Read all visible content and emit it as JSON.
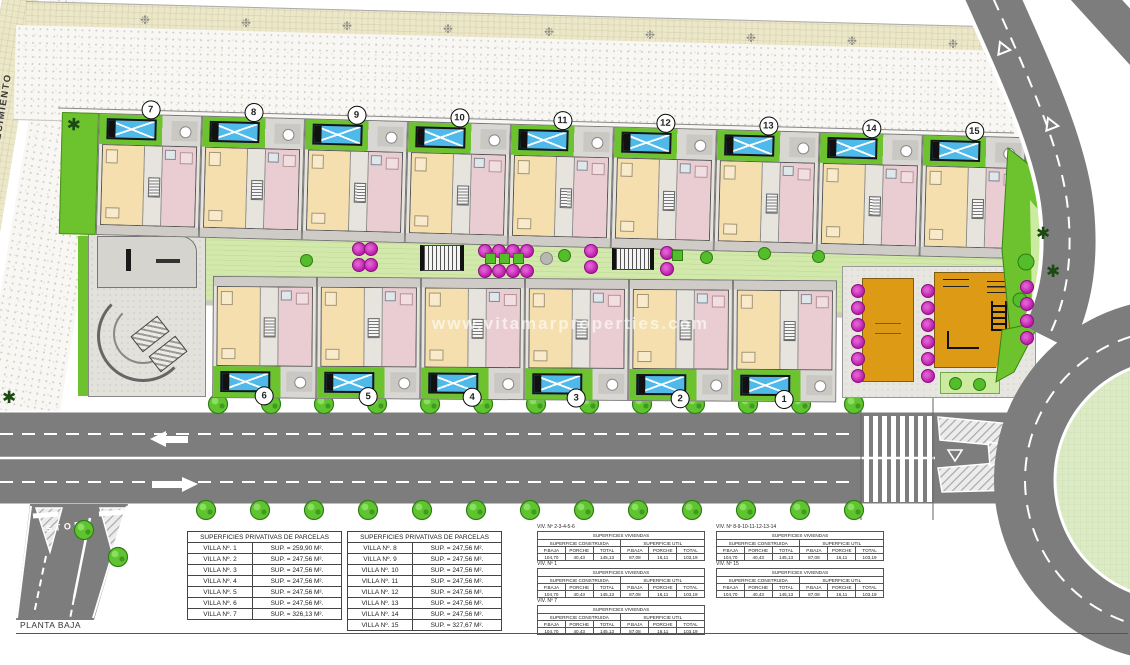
{
  "title": {
    "plan_label": "PLANTA BAJA"
  },
  "zones": {
    "protection_band": "BANDA DE PROTECCION TUBERIA ABASTECIMIENTO",
    "stop_marking": "STOP"
  },
  "watermark": "www.vitamarproperties.com",
  "icons": {
    "conifer_tree": "✱",
    "shrub": "❉"
  },
  "colors": {
    "road_gray": "#7d7d7d",
    "grass_green": "#6cc32e",
    "lawn_green": "#d2e9ab",
    "pool_blue": "#4fb9e9",
    "floor_beige": "#f5dfae",
    "floor_pink": "#eacdd2",
    "playground_orange": "#dd9b15",
    "tree_magenta": "#c52fb5",
    "band_cream": "#ece7c7",
    "roundabout_center": "#dcebc6"
  },
  "villas": {
    "top_numbers": [
      "7",
      "8",
      "9",
      "10",
      "11",
      "12",
      "13",
      "14",
      "15"
    ],
    "bottom_numbers": [
      "6",
      "5",
      "4",
      "3",
      "2",
      "1"
    ]
  },
  "tables": {
    "parcelas": [
      {
        "title": "SUPERFICIES PRIVATIVAS DE PARCELAS",
        "rows": [
          [
            "VILLA Nº. 1",
            "SUP. = 259,90 M²."
          ],
          [
            "VILLA Nº. 2",
            "SUP. = 247,56 M²."
          ],
          [
            "VILLA Nº. 3",
            "SUP. = 247,56 M²."
          ],
          [
            "VILLA Nº. 4",
            "SUP. = 247,56 M²."
          ],
          [
            "VILLA Nº. 5",
            "SUP. = 247,56 M²."
          ],
          [
            "VILLA Nº. 6",
            "SUP. = 247,56 M²."
          ],
          [
            "VILLA Nº. 7",
            "SUP. = 326,13 M²."
          ]
        ]
      },
      {
        "title": "SUPERFICIES PRIVATIVAS DE PARCELAS",
        "rows": [
          [
            "VILLA Nº. 8",
            "SUP. = 247,56 M²."
          ],
          [
            "VILLA Nº. 9",
            "SUP. = 247,56 M²."
          ],
          [
            "VILLA Nº. 10",
            "SUP. = 247,56 M²."
          ],
          [
            "VILLA Nº. 11",
            "SUP. = 247,56 M²."
          ],
          [
            "VILLA Nº. 12",
            "SUP. = 247,56 M²."
          ],
          [
            "VILLA Nº. 13",
            "SUP. = 247,56 M²."
          ],
          [
            "VILLA Nº. 14",
            "SUP. = 247,56 M²."
          ],
          [
            "VILLA Nº. 15",
            "SUP. = 327,67 M²."
          ]
        ]
      }
    ],
    "viviendas": {
      "header": "SUPERFICIES VIVIENDAS",
      "construida_label": "SUPERFICIE CONSTRUIDA",
      "util_label": "SUPERFICIE UTIL",
      "col_labels": [
        "P.BAJA",
        "PORCHE",
        "TOTAL",
        "P.BAJA",
        "PORCHE",
        "TOTAL"
      ],
      "groups": [
        {
          "title": "VIV. Nº 2-3-4-5-6",
          "values": [
            "104,70",
            "40,43",
            "145,13",
            "87,08",
            "16,11",
            "103,19"
          ]
        },
        {
          "title": "VIV. Nº 1",
          "values": [
            "104,70",
            "40,43",
            "145,13",
            "87,08",
            "16,11",
            "103,19"
          ]
        },
        {
          "title": "VIV. Nº 7",
          "values": [
            "104,70",
            "40,43",
            "145,13",
            "87,08",
            "16,11",
            "103,19"
          ]
        },
        {
          "title": "VIV. Nº 8-9-10-11-12-13-14",
          "values": [
            "104,70",
            "40,43",
            "145,13",
            "87,08",
            "16,11",
            "103,19"
          ]
        },
        {
          "title": "VIV. Nº 15",
          "values": [
            "104,70",
            "40,43",
            "145,13",
            "87,08",
            "16,11",
            "103,19"
          ]
        }
      ]
    }
  }
}
